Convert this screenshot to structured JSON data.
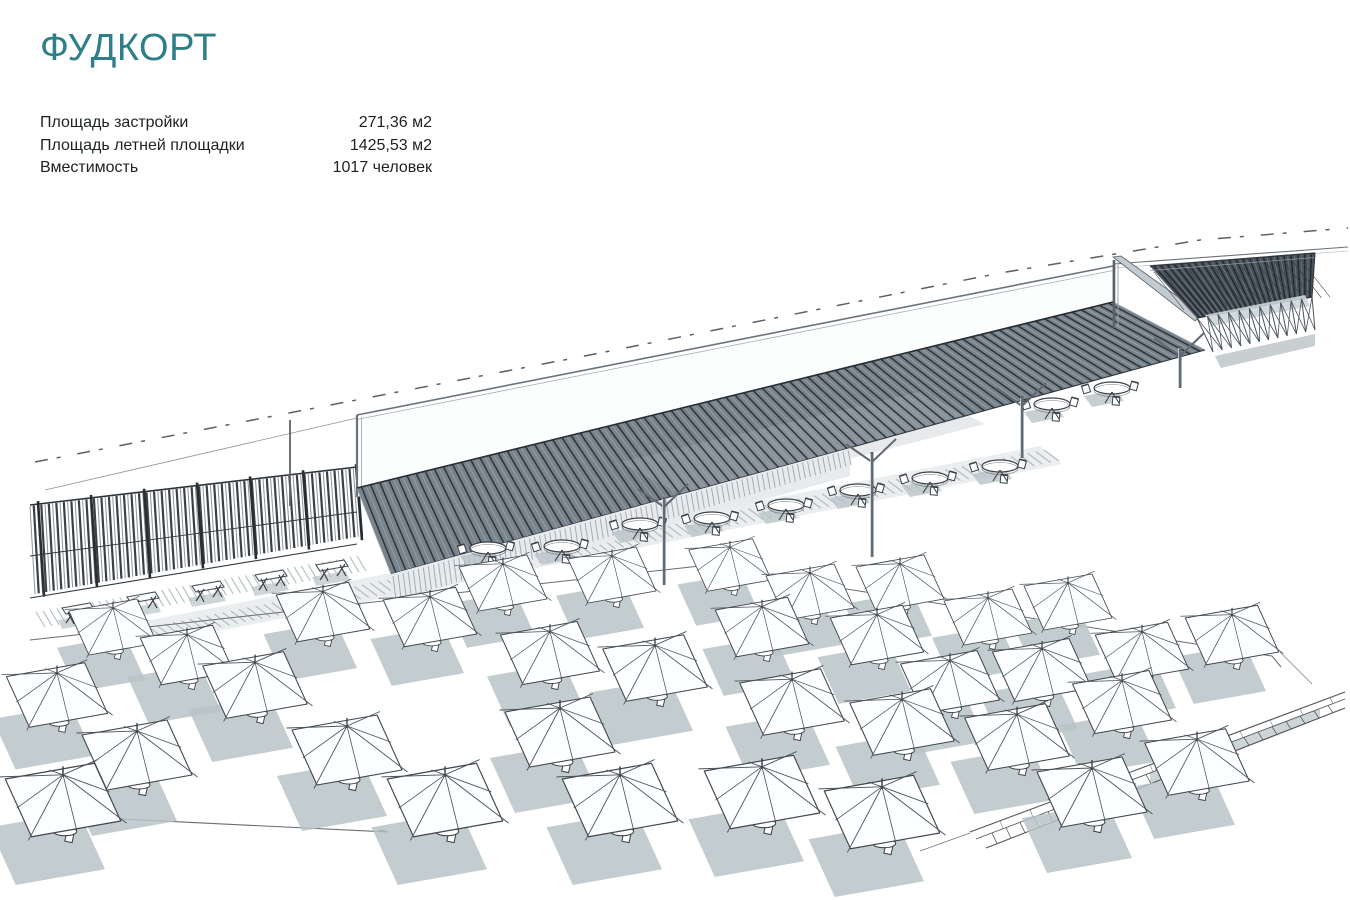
{
  "header": {
    "title": "ФУДКОРТ"
  },
  "specs": {
    "rows": [
      {
        "label": "Площадь застройки",
        "value": "271,36 м2"
      },
      {
        "label": "Площадь летней площадки",
        "value": "1425,53 м2"
      },
      {
        "label": "Вместимость",
        "value": "1017 человек"
      }
    ]
  },
  "colors": {
    "accent": "#2E7F88",
    "ink": "#3A4147",
    "line": "#5A6166",
    "shadow": "#B9C3C6",
    "roof_base": "#79838C",
    "roof_slat_dark": "#2D343A",
    "roof_slat_light": "#9AA3AB",
    "right_roof_base": "#49515A",
    "canopy_white": "#FCFDFD"
  },
  "illustration": {
    "umbrellas": [
      [
        113,
        627,
        0.8
      ],
      [
        187,
        655,
        0.85
      ],
      [
        57,
        695,
        0.92
      ],
      [
        137,
        755,
        1.0
      ],
      [
        63,
        800,
        1.05
      ],
      [
        255,
        685,
        0.95
      ],
      [
        323,
        612,
        0.85
      ],
      [
        430,
        617,
        0.85
      ],
      [
        347,
        750,
        1.0
      ],
      [
        445,
        800,
        1.05
      ],
      [
        503,
        583,
        0.8
      ],
      [
        612,
        575,
        0.8
      ],
      [
        550,
        653,
        0.9
      ],
      [
        655,
        668,
        0.95
      ],
      [
        560,
        732,
        1.0
      ],
      [
        620,
        800,
        1.05
      ],
      [
        730,
        565,
        0.75
      ],
      [
        810,
        592,
        0.8
      ],
      [
        900,
        583,
        0.8
      ],
      [
        762,
        627,
        0.85
      ],
      [
        877,
        635,
        0.85
      ],
      [
        988,
        617,
        0.8
      ],
      [
        1068,
        602,
        0.8
      ],
      [
        950,
        682,
        0.9
      ],
      [
        1042,
        670,
        0.9
      ],
      [
        1142,
        652,
        0.85
      ],
      [
        1232,
        635,
        0.85
      ],
      [
        792,
        702,
        0.95
      ],
      [
        902,
        722,
        0.95
      ],
      [
        1017,
        737,
        0.95
      ],
      [
        1122,
        702,
        0.9
      ],
      [
        762,
        792,
        1.05
      ],
      [
        882,
        812,
        1.05
      ],
      [
        1092,
        792,
        1.0
      ],
      [
        1197,
        762,
        0.95
      ]
    ],
    "round_tables": [
      [
        488,
        548
      ],
      [
        562,
        546
      ],
      [
        640,
        524
      ],
      [
        712,
        518
      ],
      [
        786,
        505
      ],
      [
        858,
        490
      ],
      [
        930,
        478
      ],
      [
        1000,
        466
      ],
      [
        1052,
        404
      ],
      [
        1112,
        388
      ]
    ],
    "benches": [
      [
        78,
        608
      ],
      [
        143,
        597
      ],
      [
        208,
        586
      ],
      [
        271,
        575
      ],
      [
        332,
        565
      ]
    ],
    "support_posts": [
      [
        664,
        497,
        88
      ],
      [
        872,
        452,
        105
      ],
      [
        1022,
        396,
        62
      ],
      [
        1180,
        346,
        42
      ]
    ]
  }
}
